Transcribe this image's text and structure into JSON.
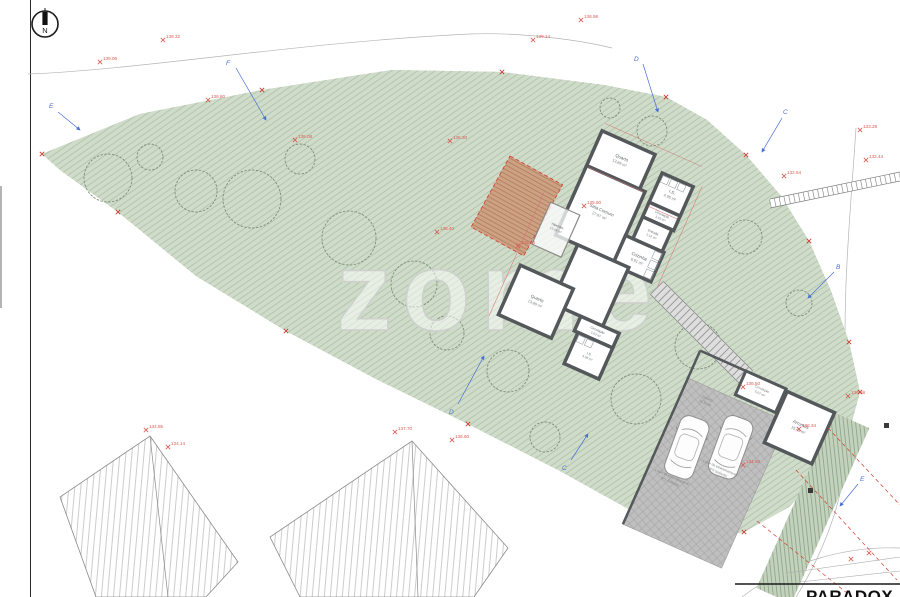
{
  "north": {
    "label": "N"
  },
  "watermark": {
    "text": "zome"
  },
  "title_block": {
    "name": "PARADOX"
  },
  "house": {
    "rooms": [
      {
        "name": "Quarto",
        "area": "13,89 m²"
      },
      {
        "name": "I.S.",
        "area": "4,95 m²"
      },
      {
        "name": "Circulação",
        "area": "3,03 m²"
      },
      {
        "name": "Entrada",
        "area": "2,19 m²"
      },
      {
        "name": "Cozinha",
        "area": "8,91 m²"
      },
      {
        "name": "Sala Comum",
        "area": "27,97 m²"
      },
      {
        "name": "Quarto",
        "area": "13,89 m²"
      },
      {
        "name": "Circulação",
        "area": "3,03 m²"
      },
      {
        "name": "I.S.",
        "area": "4,98 m²"
      },
      {
        "name": "Alpendre",
        "area": "13,08 m²"
      }
    ]
  },
  "garage": {
    "rooms": [
      {
        "name": "Arrumos",
        "area": "15,43 m²"
      },
      {
        "name": "Circulação",
        "area": "6,07 m²"
      }
    ],
    "stalls": [
      {
        "line1": "Telheiro",
        "line2": "20,52 m²"
      },
      {
        "line1": "Lugar de estacionamento",
        "line2": "Nº2 (coberto)"
      },
      {
        "line1": "Lugar de estacionamento",
        "line2": "Nº1 (coberto)"
      }
    ]
  },
  "sections": {
    "letters": [
      "E",
      "F",
      "D",
      "C",
      "B",
      "D",
      "C",
      "E"
    ]
  },
  "elevations": {
    "values": [
      "139.06",
      "139.32",
      "139.14",
      "138.98",
      "138.80",
      "138.08",
      "136.30",
      "135.60",
      "135.40",
      "134.60",
      "133.28",
      "132.44",
      "132.54",
      "134.86",
      "134.14",
      "137.70",
      "136.60",
      "136.50",
      "134.50",
      "136.58",
      "136.34"
    ]
  },
  "colors": {
    "plot_green": "#cfdcc9",
    "boundary_red": "#d23b2f",
    "wall_gray": "#54585b",
    "bed_brown": "#cda184",
    "section_blue": "#4a6fd4",
    "elevation_red": "#d85c52"
  }
}
